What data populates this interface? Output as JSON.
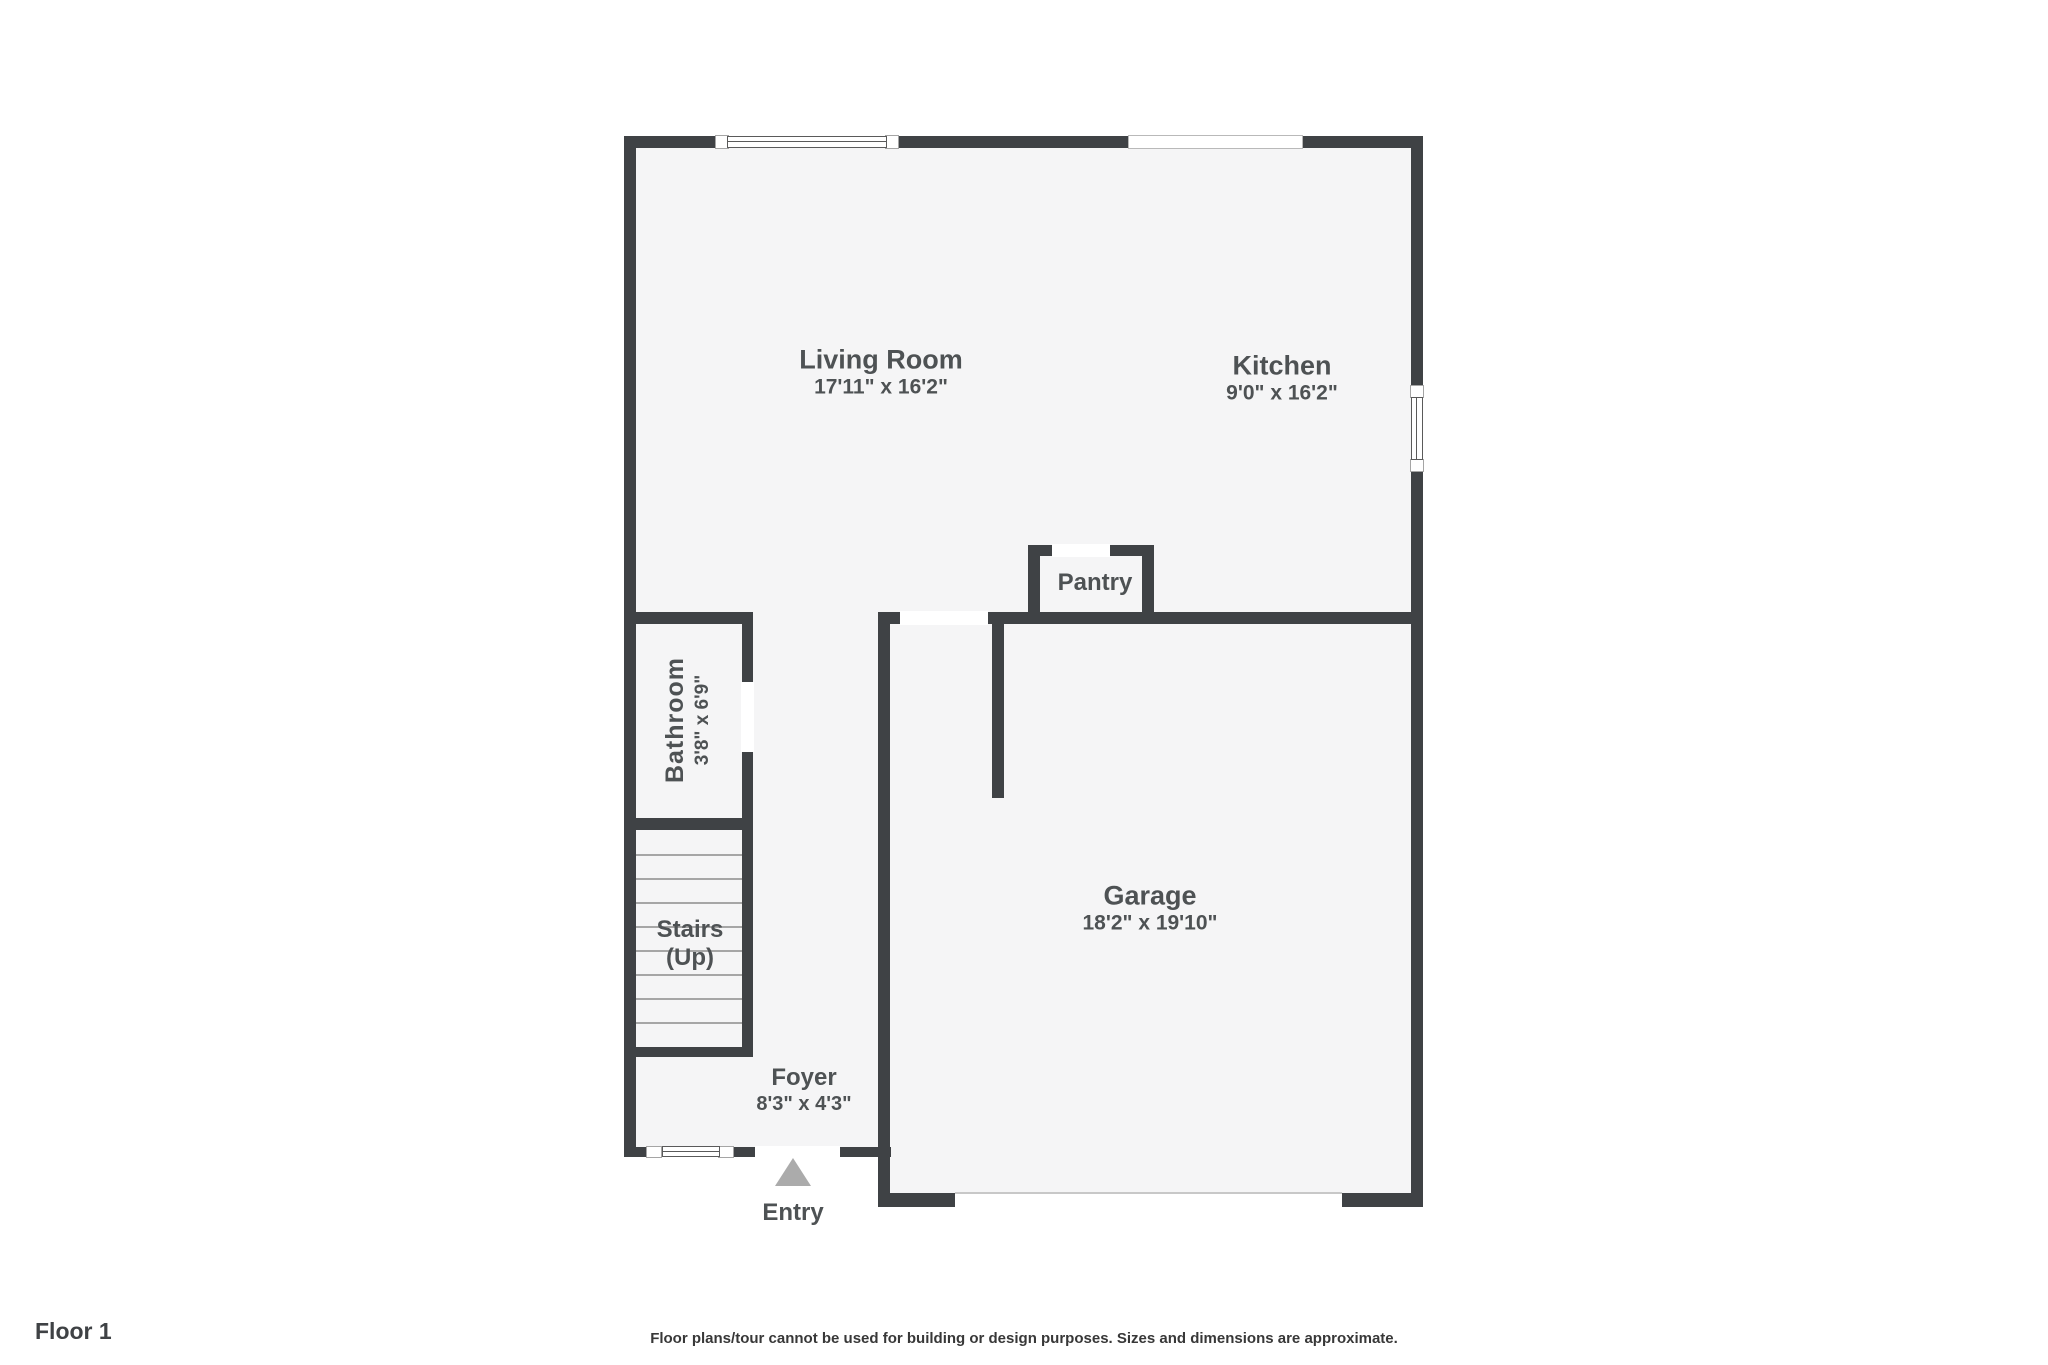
{
  "palette": {
    "wall": "#3f4245",
    "room_fill": "#f5f5f6",
    "label_text": "#4e5254",
    "entry_arrow": "#ababab",
    "stair_tread": "#a6a6a6",
    "background": "#ffffff"
  },
  "rooms": {
    "living_room": {
      "name": "Living Room",
      "dims": "17'11\" x 16'2\""
    },
    "kitchen": {
      "name": "Kitchen",
      "dims": "9'0\" x 16'2\""
    },
    "pantry": {
      "name": "Pantry"
    },
    "bathroom": {
      "name": "Bathroom",
      "dims": "3'8\" x 6'9\""
    },
    "stairs": {
      "name": "Stairs",
      "direction": "(Up)"
    },
    "foyer": {
      "name": "Foyer",
      "dims": "8'3\" x 4'3\""
    },
    "garage": {
      "name": "Garage",
      "dims": "18'2\" x 19'10\""
    },
    "entry": {
      "name": "Entry"
    }
  },
  "footer": {
    "floor_label": "Floor 1",
    "disclaimer": "Floor plans/tour cannot be used for building or design purposes. Sizes and dimensions are approximate."
  }
}
